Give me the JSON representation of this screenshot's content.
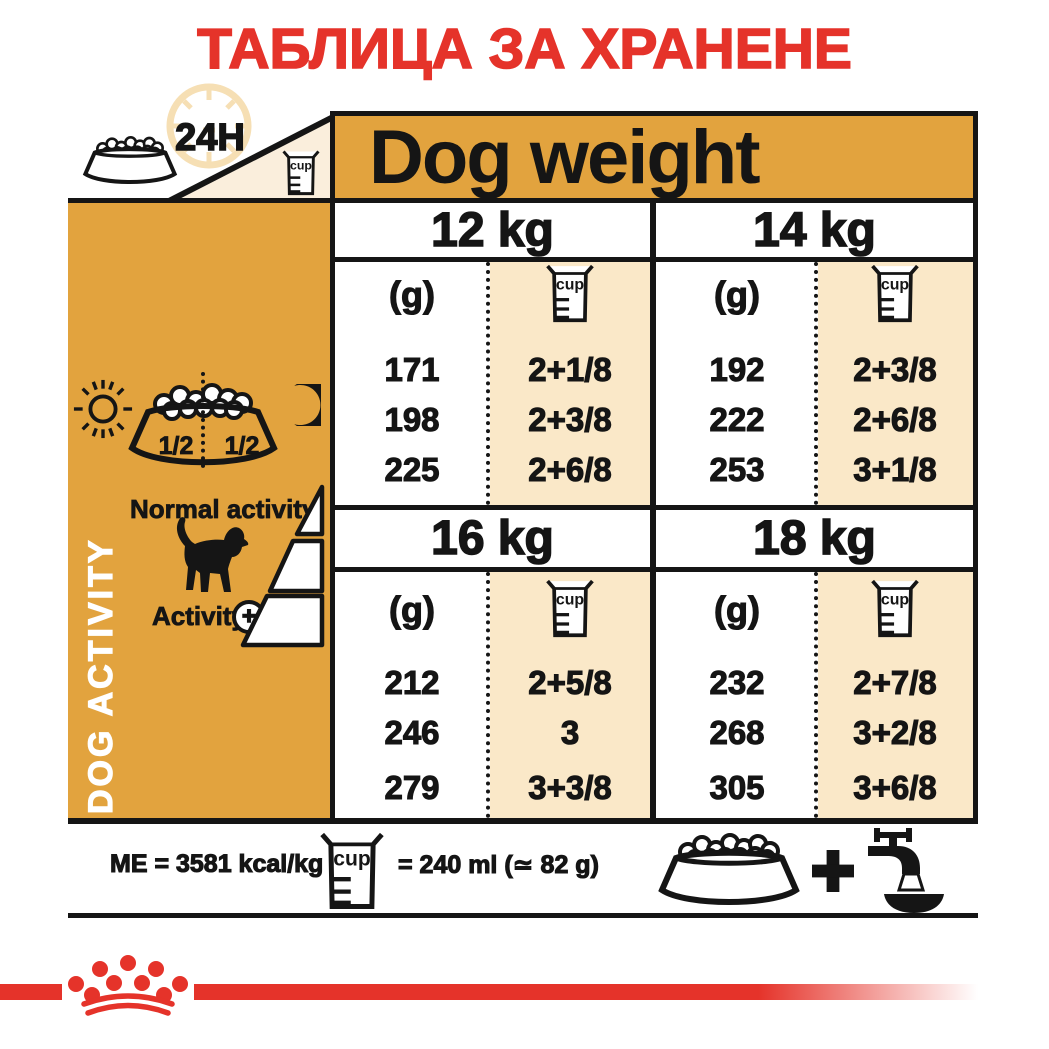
{
  "title": "ТАБЛИЦА ЗА ХРАНЕНЕ",
  "header": {
    "h24": "24H",
    "dog_weight": "Dog weight"
  },
  "icons": {
    "cup_label": "cup"
  },
  "sidebar": {
    "dog_activity": "DOG ACTIVITY",
    "half_left": "1/2",
    "half_right": "1/2",
    "normal_activity": "Normal activity",
    "activity": "Activity",
    "activity_plus": "+"
  },
  "table": {
    "sections": [
      {
        "weight": "12 kg",
        "g_header": "(g)",
        "rows": [
          {
            "g": "171",
            "cups": "2+1/8"
          },
          {
            "g": "198",
            "cups": "2+3/8"
          },
          {
            "g": "225",
            "cups": "2+6/8"
          }
        ]
      },
      {
        "weight": "14 kg",
        "g_header": "(g)",
        "rows": [
          {
            "g": "192",
            "cups": "2+3/8"
          },
          {
            "g": "222",
            "cups": "2+6/8"
          },
          {
            "g": "253",
            "cups": "3+1/8"
          }
        ]
      },
      {
        "weight": "16 kg",
        "g_header": "(g)",
        "rows": [
          {
            "g": "212",
            "cups": "2+5/8"
          },
          {
            "g": "246",
            "cups": "3"
          },
          {
            "g": "279",
            "cups": "3+3/8"
          }
        ]
      },
      {
        "weight": "18 kg",
        "g_header": "(g)",
        "rows": [
          {
            "g": "232",
            "cups": "2+7/8"
          },
          {
            "g": "268",
            "cups": "3+2/8"
          },
          {
            "g": "305",
            "cups": "3+6/8"
          }
        ]
      }
    ]
  },
  "footer": {
    "me": "ME = 3581 kcal/kg",
    "cup_equiv": "= 240 ml (≃ 82 g)",
    "plus": "+"
  },
  "colors": {
    "red": "#E5332A",
    "orange": "#E2A33E",
    "cream": "#FAE8C8",
    "cream_light": "#FAEEDC",
    "black": "#151515"
  }
}
